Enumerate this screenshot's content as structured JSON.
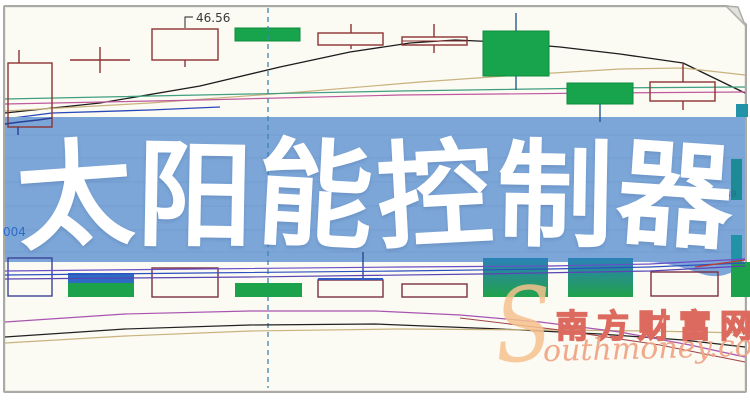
{
  "page": {
    "width": 750,
    "height": 400,
    "bg": "#ffffff"
  },
  "card": {
    "bg": "#fbfaf3",
    "border_color": "#aba9a4"
  },
  "banner": {
    "title": "太阳能控制器",
    "chars": [
      {
        "ch": "太",
        "rot": -4
      },
      {
        "ch": "阳",
        "rot": 1
      },
      {
        "ch": "能",
        "rot": 3
      },
      {
        "ch": "控",
        "rot": -3
      },
      {
        "ch": "制",
        "rot": 1
      },
      {
        "ch": "器",
        "rot": 4
      }
    ],
    "bg": "#7ca6d8",
    "fg": "#ffffff"
  },
  "watermark": {
    "swoosh": "S",
    "cn": "南方财富网",
    "en": "outhmoney.com",
    "cn_color": "#dd6a5e",
    "en_color": "#f0a585",
    "swoosh_color": "#f6c28e"
  },
  "chart_data": {
    "type": "candlestick",
    "note": "Stock K-line chart background; axes and scale labels are hidden by the overlay banner. Only one price label (46.56), a clipped code fragment (004) and a clipped price fragment (39.) are visible.",
    "labels": {
      "price_marker": {
        "text": "46.56",
        "x": 196,
        "y": 22,
        "color": "#3a3a3a",
        "size": 12
      },
      "left_code": {
        "text": "004",
        "x": 3,
        "y": 236,
        "color": "#2e6cc8",
        "size": 12
      },
      "right_price": {
        "text": "39.",
        "x": 725,
        "y": 197,
        "color": "#256f80",
        "size": 9
      }
    },
    "leader_line": {
      "color": "#4a4a4a",
      "points": [
        [
          185,
          28
        ],
        [
          185,
          17
        ],
        [
          193,
          17
        ]
      ]
    },
    "dashed_vline": {
      "x": 268,
      "y1": 8,
      "y2": 388,
      "color": "#3d85b0"
    },
    "colors": {
      "hollow_candle": "#8e3333",
      "green_fill": "#18a44d",
      "green_stroke": "#0e8c3e",
      "gradient_top": "#2b81b8",
      "gradient_bottom": "#21a24a"
    },
    "top_candles": [
      {
        "kind": "hollow",
        "x": 8,
        "y": 63,
        "w": 44,
        "h": 64,
        "wicks": [
          [
            19,
            50,
            63
          ]
        ]
      },
      {
        "kind": "doji",
        "hline": [
          70,
          130,
          60
        ],
        "vline": [
          100,
          47,
          73
        ]
      },
      {
        "kind": "hollow",
        "x": 152,
        "y": 29,
        "w": 66,
        "h": 31,
        "wicks": [
          [
            185,
            60,
            67
          ]
        ]
      },
      {
        "kind": "green",
        "x": 235,
        "y": 28,
        "w": 65,
        "h": 13,
        "wicks": []
      },
      {
        "kind": "hollow",
        "x": 318,
        "y": 33,
        "w": 65,
        "h": 12,
        "wicks": [
          [
            351,
            24,
            33
          ],
          [
            351,
            45,
            49
          ]
        ]
      },
      {
        "kind": "hollow",
        "x": 402,
        "y": 37,
        "w": 65,
        "h": 8,
        "wicks": [
          [
            434,
            24,
            37
          ],
          [
            434,
            45,
            53
          ]
        ],
        "inner_line": 41
      },
      {
        "kind": "green",
        "x": 483,
        "y": 31,
        "w": 66,
        "h": 45,
        "wicks": [
          [
            516,
            13,
            31
          ],
          [
            516,
            76,
            90
          ]
        ]
      },
      {
        "kind": "green",
        "x": 567,
        "y": 83,
        "w": 66,
        "h": 21,
        "wicks": [
          [
            600,
            104,
            116
          ]
        ]
      },
      {
        "kind": "hollow",
        "x": 650,
        "y": 82,
        "w": 65,
        "h": 19,
        "wicks": [
          [
            683,
            63,
            82
          ],
          [
            683,
            101,
            110
          ]
        ]
      }
    ],
    "right_edge_bars": [
      {
        "x": 736,
        "y": 104,
        "w": 12,
        "h": 13,
        "color": "#2292a6"
      },
      {
        "x": 731,
        "y": 159,
        "w": 11,
        "h": 41,
        "color": "#1d8b96"
      },
      {
        "x": 731,
        "y": 235,
        "w": 11,
        "h": 27,
        "color": "#2292a6"
      }
    ],
    "volume_bars": [
      {
        "x": 8,
        "y": 258,
        "w": 44,
        "h": 38,
        "kind": "hollow",
        "color": "#3c4496"
      },
      {
        "x": 68,
        "y": 273,
        "w": 66,
        "h": 11,
        "kind": "fill",
        "color": "#2e6cc4"
      },
      {
        "x": 68,
        "y": 283,
        "w": 66,
        "h": 14,
        "kind": "fill",
        "color": "#1da24c"
      },
      {
        "x": 152,
        "y": 268,
        "w": 66,
        "h": 29,
        "kind": "hollow",
        "color": "#7d3040"
      },
      {
        "x": 235,
        "y": 283,
        "w": 67,
        "h": 14,
        "kind": "fill",
        "color": "#1da24c"
      },
      {
        "x": 318,
        "y": 280,
        "w": 65,
        "h": 17,
        "kind": "hollow",
        "color": "#7d3040",
        "topline": "#2e5cc4"
      },
      {
        "x": 402,
        "y": 284,
        "w": 65,
        "h": 13,
        "kind": "hollow",
        "color": "#7d3040"
      },
      {
        "x": 483,
        "y": 258,
        "w": 65,
        "h": 39,
        "kind": "gradient"
      },
      {
        "x": 568,
        "y": 258,
        "w": 65,
        "h": 39,
        "kind": "gradient"
      },
      {
        "x": 651,
        "y": 272,
        "w": 67,
        "h": 24,
        "kind": "hollow",
        "color": "#7d3040"
      },
      {
        "x": 731,
        "y": 262,
        "w": 19,
        "h": 35,
        "kind": "fill",
        "color": "#1da24c"
      }
    ],
    "ma_top": [
      {
        "color": "#1c1c1c",
        "w": 1.3,
        "points": [
          [
            5,
            113
          ],
          [
            100,
            103
          ],
          [
            200,
            86
          ],
          [
            280,
            67
          ],
          [
            350,
            52
          ],
          [
            410,
            43
          ],
          [
            455,
            40
          ],
          [
            500,
            42
          ],
          [
            560,
            47
          ],
          [
            620,
            54
          ],
          [
            683,
            63
          ],
          [
            745,
            93
          ]
        ]
      },
      {
        "color": "#c9b27e",
        "w": 1.2,
        "points": [
          [
            5,
            111
          ],
          [
            150,
            103
          ],
          [
            300,
            92
          ],
          [
            420,
            82
          ],
          [
            520,
            75
          ],
          [
            620,
            69
          ],
          [
            683,
            68
          ],
          [
            745,
            75
          ]
        ]
      },
      {
        "color": "#3f9f7f",
        "w": 1.2,
        "points": [
          [
            5,
            99
          ],
          [
            200,
            95
          ],
          [
            400,
            91
          ],
          [
            600,
            88
          ],
          [
            745,
            87
          ]
        ]
      },
      {
        "color": "#bf5a9e",
        "w": 1.2,
        "points": [
          [
            5,
            104
          ],
          [
            200,
            100
          ],
          [
            400,
            95
          ],
          [
            600,
            93
          ],
          [
            745,
            92
          ]
        ]
      },
      {
        "color": "#2a49b8",
        "w": 1.3,
        "points": [
          [
            5,
            119
          ],
          [
            52,
            113
          ],
          [
            150,
            110
          ],
          [
            220,
            107
          ]
        ]
      }
    ],
    "ma_volume": [
      {
        "color": "#6b4fc8",
        "w": 1.2,
        "points": [
          [
            5,
            271
          ],
          [
            200,
            269
          ],
          [
            400,
            267
          ],
          [
            550,
            266
          ],
          [
            650,
            264
          ],
          [
            745,
            259
          ]
        ]
      },
      {
        "color": "#2d50c0",
        "w": 1.2,
        "points": [
          [
            5,
            275
          ],
          [
            200,
            273
          ],
          [
            400,
            271
          ],
          [
            550,
            269
          ],
          [
            650,
            267
          ],
          [
            745,
            263
          ]
        ]
      },
      {
        "color": "#5a44b4",
        "w": 1.2,
        "points": [
          [
            5,
            279
          ],
          [
            250,
            277
          ],
          [
            480,
            274
          ],
          [
            650,
            271
          ],
          [
            745,
            266
          ]
        ]
      },
      {
        "color": "#c03a2e",
        "w": 1.2,
        "points": [
          [
            695,
            267
          ],
          [
            745,
            260
          ]
        ]
      }
    ],
    "ma_bottom": [
      {
        "color": "#222222",
        "w": 1.2,
        "points": [
          [
            5,
            337
          ],
          [
            125,
            329
          ],
          [
            250,
            325
          ],
          [
            375,
            324
          ],
          [
            500,
            329
          ],
          [
            600,
            334
          ],
          [
            683,
            340
          ],
          [
            745,
            347
          ]
        ]
      },
      {
        "color": "#c9b27e",
        "w": 1.2,
        "points": [
          [
            5,
            343
          ],
          [
            125,
            336
          ],
          [
            250,
            331
          ],
          [
            400,
            329
          ],
          [
            550,
            330
          ],
          [
            650,
            331
          ],
          [
            745,
            333
          ]
        ]
      },
      {
        "color": "#a855b0",
        "w": 1.2,
        "points": [
          [
            5,
            322
          ],
          [
            125,
            314
          ],
          [
            250,
            311
          ],
          [
            375,
            311
          ],
          [
            460,
            315
          ],
          [
            540,
            322
          ],
          [
            620,
            332
          ],
          [
            690,
            345
          ],
          [
            745,
            357
          ]
        ]
      },
      {
        "color": "#a04545",
        "w": 1.1,
        "points": [
          [
            460,
            318
          ],
          [
            560,
            330
          ],
          [
            660,
            345
          ],
          [
            745,
            362
          ]
        ]
      }
    ],
    "overlay_lines": [
      {
        "color": "#2a3f96",
        "w": 1.4,
        "points": [
          [
            5,
            124
          ],
          [
            20,
            122
          ],
          [
            38,
            120
          ],
          [
            52,
            118
          ]
        ]
      },
      {
        "color": "#2a3f96",
        "w": 1.4,
        "points": [
          [
            18,
            127
          ],
          [
            18,
            135
          ]
        ]
      },
      {
        "color": "#2a4a8f",
        "w": 1.4,
        "points": [
          [
            363,
            252
          ],
          [
            363,
            280
          ]
        ]
      },
      {
        "color": "#2a5a8f",
        "w": 1.4,
        "points": [
          [
            600,
            116
          ],
          [
            600,
            122
          ]
        ]
      }
    ],
    "banner_shape": "M5,117 L745,117 L745,260 C737,273 720,280 702,274 C684,268 668,262 645,262 L5,262 Z"
  }
}
